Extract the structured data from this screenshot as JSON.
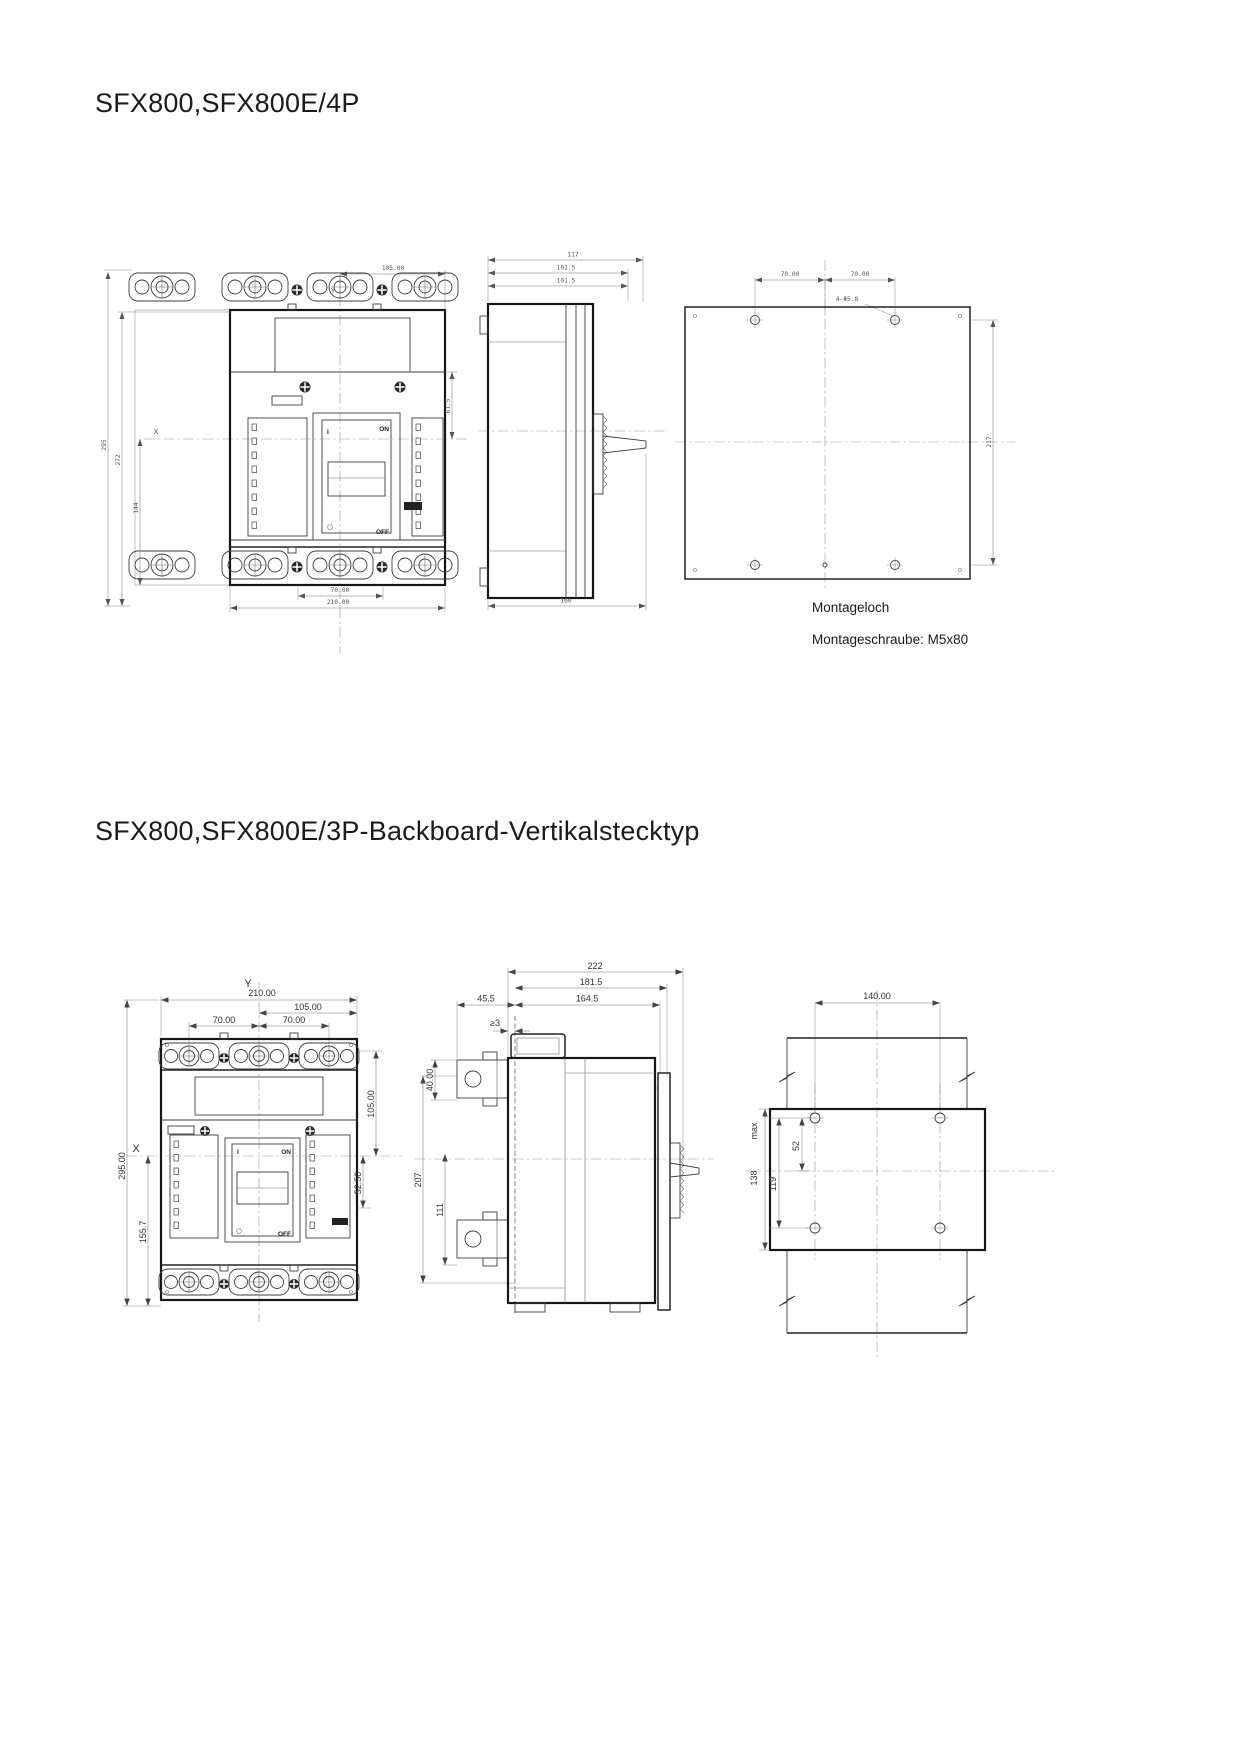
{
  "section1": {
    "title": "SFX800,SFX800E/4P",
    "front_view": {
      "axis_y": "Y",
      "axis_x": "X",
      "dim_top": "105.00",
      "dim_bottom_inner": "70.00",
      "dim_bottom_outer": "210.00",
      "dim_left_outer": "295",
      "dim_left_mid": "272",
      "dim_left_inner": "144",
      "dim_right_inner": "61.5",
      "label_on": "ON",
      "label_off": "OFF",
      "label_i": "I"
    },
    "side_view": {
      "dim_depth_outer": "117",
      "dim_depth_mid": "101.5",
      "dim_depth_inner": "101.5",
      "dim_bottom": "160"
    },
    "plate_view": {
      "dim_left_span": "70.00",
      "dim_right_span": "70.00",
      "hole_note": "4-Φ5.8",
      "dim_vertical": "217"
    },
    "notes": {
      "line1": "Montageloch",
      "line2": "Montageschraube: M5x80"
    }
  },
  "section2": {
    "title": "SFX800,SFX800E/3P-Backboard-Vertikalstecktyp",
    "front_view": {
      "axis_y": "Y",
      "axis_x": "X",
      "dim_width": "210.00",
      "dim_half_width": "105.00",
      "dim_pole_left": "70.00",
      "dim_pole_right": "70.00",
      "dim_height": "295.00",
      "dim_lower_height": "155.7",
      "dim_right_upper": "105.00",
      "dim_right_lower": "52.50",
      "label_on": "ON",
      "label_off": "OFF",
      "label_i": "I"
    },
    "side_view": {
      "dim_total_depth": "222",
      "dim_depth_181": "181.5",
      "dim_depth_164": "164.5",
      "dim_stab": "45.5",
      "dim_clearance": "≥3",
      "dim_stab_height": "40.00",
      "dim_height_207": "207",
      "dim_height_111": "111"
    },
    "plate_view": {
      "dim_width": "140.00",
      "dim_height_max": "138",
      "dim_height_max_suffix": "max",
      "dim_holes_v": "119",
      "dim_holes_half": "52"
    }
  }
}
